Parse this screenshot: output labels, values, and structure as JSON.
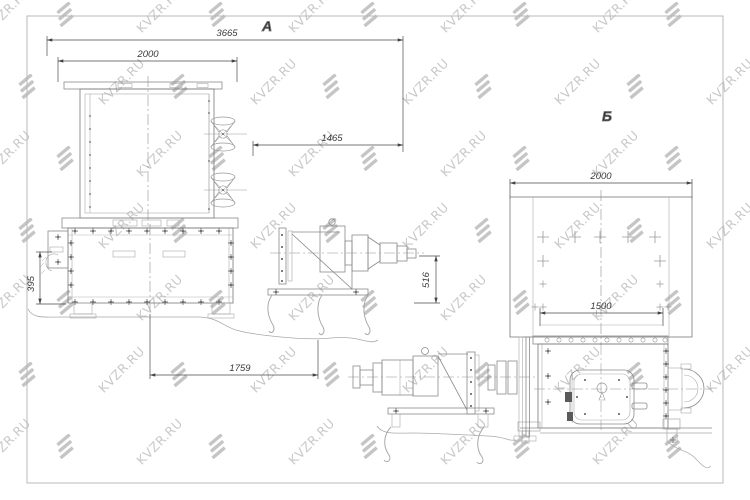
{
  "watermark": {
    "text": "KVZR.RU",
    "color": "#c9c9c9",
    "logo_color": "#c5c5c5"
  },
  "drawing": {
    "line_color": "#777777",
    "views": [
      {
        "id": "A",
        "label": "А",
        "dimensions": {
          "overall_width": "3665",
          "body_width": "2000",
          "drive_extension": "1465",
          "axis_height": "516",
          "bracket_height": "395",
          "base_span": "1759"
        }
      },
      {
        "id": "B",
        "label": "Б",
        "dimensions": {
          "hopper_width": "2000",
          "opening_width": "1500"
        }
      }
    ]
  }
}
